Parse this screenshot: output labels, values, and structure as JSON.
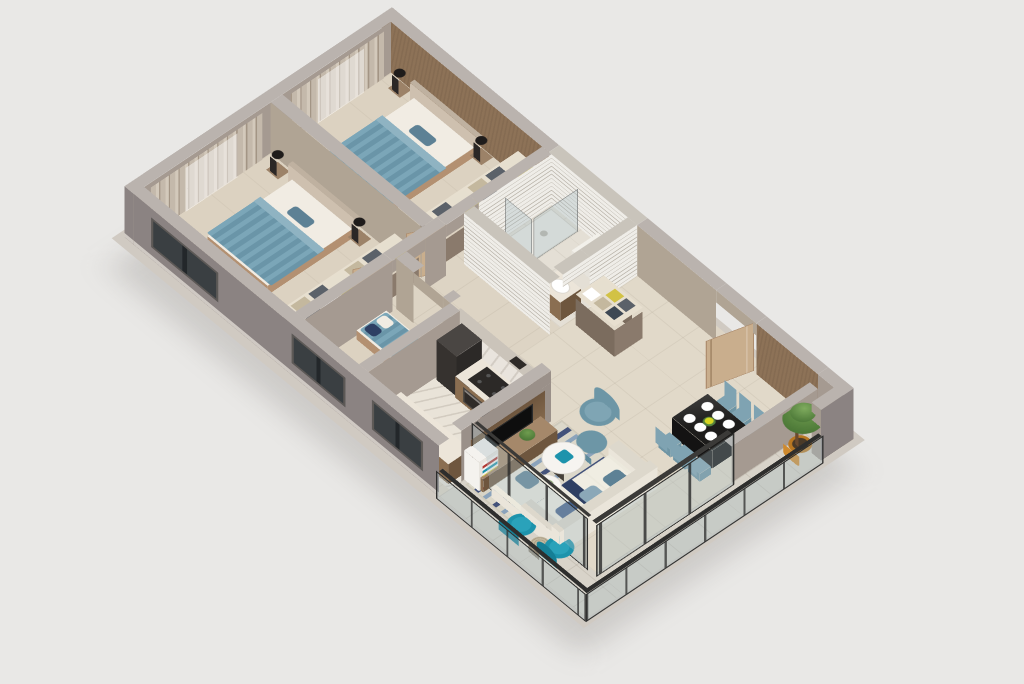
{
  "scene": {
    "type": "isometric-3d-floor-plan-render",
    "background": "#e9e8e6",
    "view": "axonometric, long axis upper-left to lower-right"
  },
  "palette": {
    "wall_outer": "#8b8382",
    "wall_outer_dark": "#7d7574",
    "wall_top": "#bab3ae",
    "wall_inner": "#a59a91",
    "wall_inner_warm": "#b0a494",
    "accent_wall": "#8d7257",
    "bath_tile": "#efede8",
    "bath_tile_line": "#b8b2a8",
    "bath_wall_top": "#c9c4bb",
    "floor_base": "#ddd4c4",
    "floor_bedroom": "#dcd2c1",
    "floor_bath": "#e4dfd5",
    "floor_living": "#e1d9c9",
    "floor_kitchen": "#e9e3d8",
    "floor_balcony": "#d8d3c9",
    "marble": "#e9e4dd",
    "wood_cabinet": "#8a6e51",
    "wood_dark": "#6e563e",
    "wood_mid": "#9c8268",
    "counter_top": "#ece5d9",
    "bed_blanket_a": "#7ba6b8",
    "bed_blanket_b": "#6a95a8",
    "bed_frame": "#b39071",
    "headboard": "#cec0af",
    "pillow": "#f1ece3",
    "curtain": "#c4b9ab",
    "curtain_dark": "#a39585",
    "sofa": "#eae5da",
    "sofa_cushion": "#ece9dd",
    "sofa_pillow_blue": "#5d8195",
    "sofa_pillow_steel": "#8ba8b8",
    "navy": "#2e3f63",
    "rug_light": "#dcd8ca",
    "rug_navy": "#43527a",
    "rug_steel": "#8ba3bb",
    "teal_chair": "#1d93ac",
    "teal_chair_dark": "#157f96",
    "dining_chair": "#7fa3b2",
    "table_black": "#1d1c1b",
    "plate_white": "#ffffff",
    "flower_yellow": "#d6d622",
    "glass": "rgba(168,188,192,0.34)",
    "frame_dark": "#2e2e2d",
    "plant_green_hi": "#6f9c4f",
    "plant_green_lo": "#3f6b2e",
    "pot_orange": "#cf8a2e",
    "door_wood": "#c9ae8d",
    "tv_black": "#0e0e0e",
    "appliance_dark": "#36322f",
    "clothes": [
      "#e6dfcf",
      "#d2c245",
      "#5b6169",
      "#ffffff",
      "#c4b89e",
      "#3e4854"
    ]
  },
  "dining": {
    "plates": 6,
    "chairs": 6,
    "centerpiece": "yellow-flowers"
  },
  "balcony": {
    "armchairs": 2,
    "side_table": 1,
    "potted_tree": 1
  },
  "rooms": [
    {
      "name": "bedroom-1",
      "furniture": [
        "double-bed",
        "headboard",
        "nightstands",
        "table-lamps",
        "wardrobe-open-shelves",
        "curtains",
        "foot-bench"
      ]
    },
    {
      "name": "bedroom-2",
      "furniture": [
        "double-bed",
        "headboard",
        "nightstands",
        "table-lamps",
        "wardrobe-open-shelves",
        "curtains",
        "accent-wall",
        "foot-bench"
      ]
    },
    {
      "name": "bathroom",
      "furniture": [
        "shower",
        "glass-partition",
        "bathtub",
        "vanity-sink",
        "toilet",
        "slatted-tile-walls"
      ]
    },
    {
      "name": "entry-hall",
      "furniture": [
        "entrance-door-open",
        "storage-cabinet-open-shelves"
      ]
    },
    {
      "name": "study-bedroom-3",
      "furniture": [
        "daybed-striped"
      ]
    },
    {
      "name": "kitchen",
      "furniture": [
        "counter",
        "cooktop",
        "oven",
        "fridge",
        "marble-backsplash",
        "coffee-machine",
        "lower-counter"
      ]
    },
    {
      "name": "living-room",
      "furniture": [
        "tv-wall-panel",
        "tv",
        "media-cabinet",
        "bookshelf",
        "sofa-sectional",
        "blue-striped-rug",
        "round-coffee-tables",
        "accent-armchair",
        "ottoman",
        "sliding-glass-doors"
      ]
    },
    {
      "name": "dining-area",
      "furniture": [
        "black-dining-table",
        "plates",
        "flower-centerpiece",
        "six-chairs"
      ]
    },
    {
      "name": "balcony",
      "furniture": [
        "glass-railing",
        "teal-armchairs",
        "wicker-side-table",
        "potted-tree"
      ]
    }
  ]
}
